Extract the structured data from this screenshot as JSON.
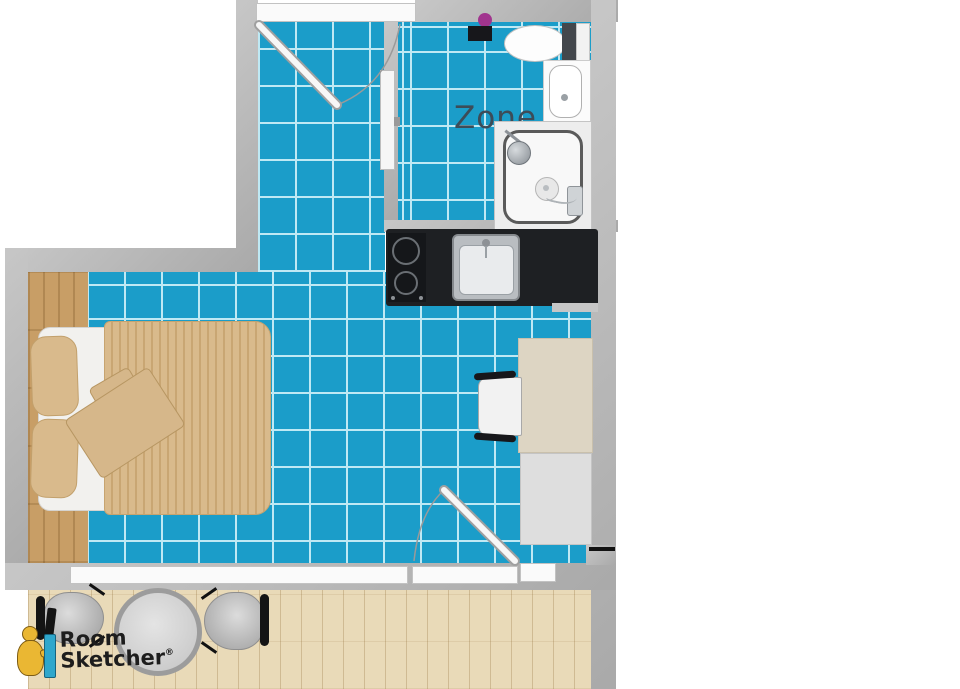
{
  "plan": {
    "zone_label": "Zone"
  },
  "watermark": {
    "brand_line1": "Room",
    "brand_line2": "Sketcher",
    "registered_mark": "®"
  },
  "objects": [
    "entry-door",
    "sliding-door",
    "toilet",
    "toilet-accessory-box",
    "purple-accent-dot",
    "bathroom-sink",
    "shower",
    "cooktop",
    "kitchen-sink",
    "kitchen-counter",
    "bed",
    "pillow",
    "pillow",
    "folded-blanket",
    "desk",
    "desk-chair",
    "wardrobe-cabinet",
    "balcony-door",
    "bottom-window",
    "round-patio-table",
    "patio-chair-left",
    "patio-chair-right"
  ],
  "colors": {
    "tile": "#1b9dc9",
    "grout": "#bfe9f4",
    "wall": "#b4b4b4",
    "wood_nook": "#c89e66",
    "deck": "#e9dab8",
    "counter": "#1e2023",
    "duvet": "#d9ba8c",
    "duvet_stripe": "#c9a673",
    "bed_sheet": "#f2f1ee",
    "desk": "#ddd5c3",
    "cabinet": "#dedede",
    "fixture_white": "#fafafa",
    "accent_purple": "#a1348e",
    "zone_text": "#3c4c58",
    "logo_text": "#1d1d1d",
    "logo_pencil": "#2fa7cc",
    "logo_figure": "#eab733",
    "chair_gray": "#c2c2c2"
  }
}
